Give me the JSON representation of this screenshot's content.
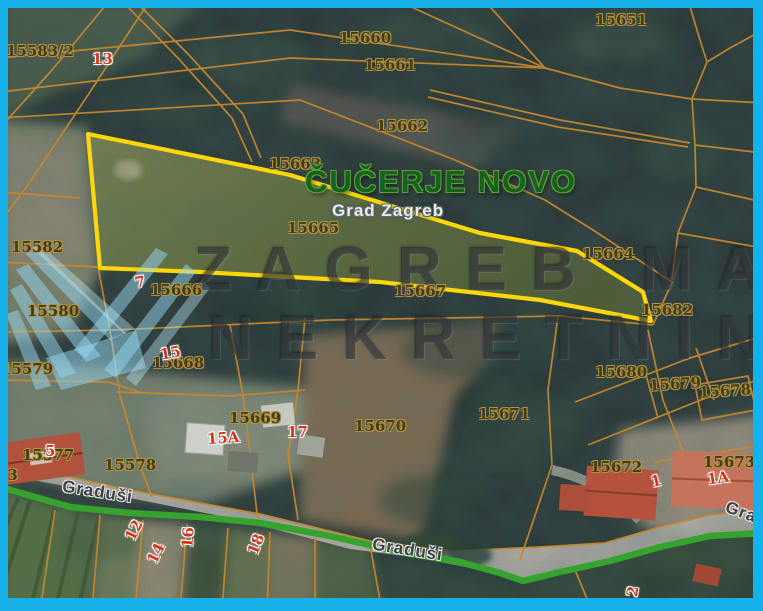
{
  "map": {
    "settlement": {
      "title": "ČUČERJE NOVO",
      "subtitle": "Grad Zagreb"
    },
    "watermark": {
      "line1": "ZAGREB MAX",
      "line2": "NEKRETNINE"
    },
    "streets": [
      {
        "name": "Graduši"
      },
      {
        "name": "Graduši"
      },
      {
        "name": "Graduši"
      }
    ],
    "parcels": [
      {
        "label": "15583/2"
      },
      {
        "label": "15651"
      },
      {
        "label": "15660"
      },
      {
        "label": "15661"
      },
      {
        "label": "15662"
      },
      {
        "label": "15663"
      },
      {
        "label": "15665"
      },
      {
        "label": "15664"
      },
      {
        "label": "15582"
      },
      {
        "label": "15580"
      },
      {
        "label": "15579"
      },
      {
        "label": "15666"
      },
      {
        "label": "15667"
      },
      {
        "label": "15668"
      },
      {
        "label": "15669"
      },
      {
        "label": "15670"
      },
      {
        "label": "15671"
      },
      {
        "label": "15680"
      },
      {
        "label": "15679"
      },
      {
        "label": "15678"
      },
      {
        "label": "15682"
      },
      {
        "label": "15672"
      },
      {
        "label": "15673"
      },
      {
        "label": "15577"
      },
      {
        "label": "15578"
      },
      {
        "label": "73"
      }
    ],
    "house_numbers": [
      {
        "number": "13"
      },
      {
        "number": "7"
      },
      {
        "number": "15"
      },
      {
        "number": "5"
      },
      {
        "number": "15A"
      },
      {
        "number": "17"
      },
      {
        "number": "1"
      },
      {
        "number": "1A"
      },
      {
        "number": "12"
      },
      {
        "number": "14"
      },
      {
        "number": "16"
      },
      {
        "number": "18"
      },
      {
        "number": "2"
      }
    ],
    "colors": {
      "frame": "#17b0e8",
      "highlight_outline": "#ffd608",
      "road_line": "#36a32e",
      "parcel_line": "#c6872e",
      "parcel_label": "#4a3b0a",
      "house_number": "#d5331b",
      "settlement_text": "#17611b"
    }
  }
}
